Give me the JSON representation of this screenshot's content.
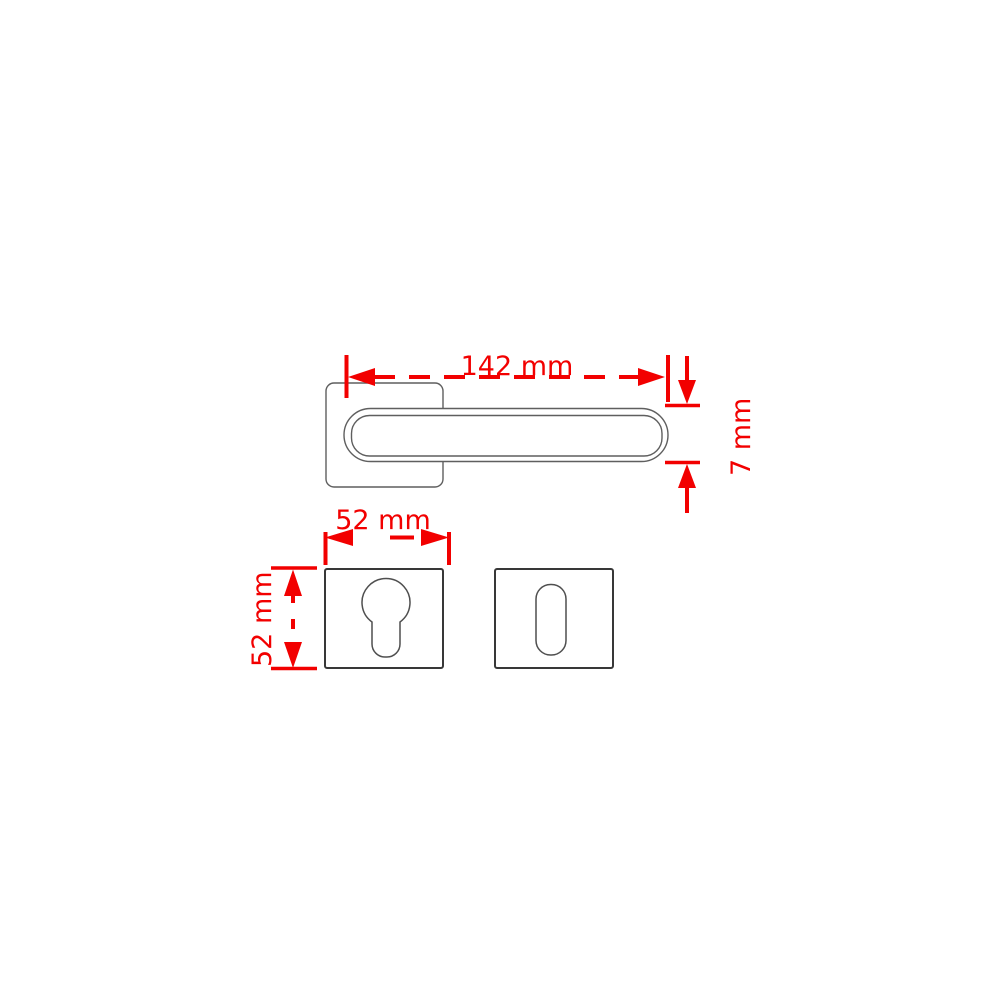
{
  "page": {
    "background": "#ffffff"
  },
  "drawing": {
    "colors": {
      "dimension_red": "#f20000",
      "outline_gray": "#5f5f5f",
      "outline_dark_gray": "#383838",
      "fill": "#ffffff"
    },
    "dimensions": {
      "handle_length": "142 mm",
      "handle_thickness": "7 mm",
      "escutcheon_width": "52 mm",
      "escutcheon_height": "52 mm"
    }
  }
}
